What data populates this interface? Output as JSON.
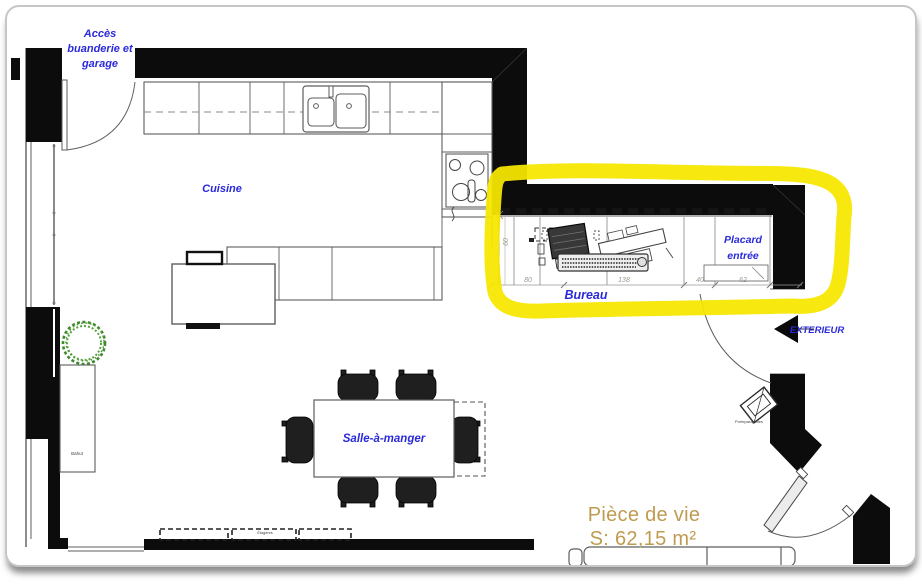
{
  "colors": {
    "highlight_yellow": "#f6e800",
    "label_blue": "#2a2ada",
    "area_gold": "#bf9b50",
    "wall_black": "#0c0c0c"
  },
  "plan": {
    "access_label": {
      "line1": "Accès",
      "line2": "buanderie et",
      "line3": "garage"
    },
    "rooms": {
      "cuisine": "Cuisine",
      "bureau": "Bureau",
      "placard": {
        "line1": "Placard",
        "line2": "entrée"
      },
      "salle_a_manger": "Salle-à-manger"
    },
    "living_area": {
      "name": "Pièce de vie",
      "surface": "S: 62,15 m²"
    },
    "exterior_label": "EXTERIEUR",
    "furniture": {
      "bahut": "Bahut",
      "porte_parapluies": "Porteparapluies",
      "etageres": "Étagères"
    },
    "dimensions": {
      "bureau_segments": [
        "80",
        "138",
        "40",
        "62"
      ],
      "bureau_depth": "60"
    }
  }
}
